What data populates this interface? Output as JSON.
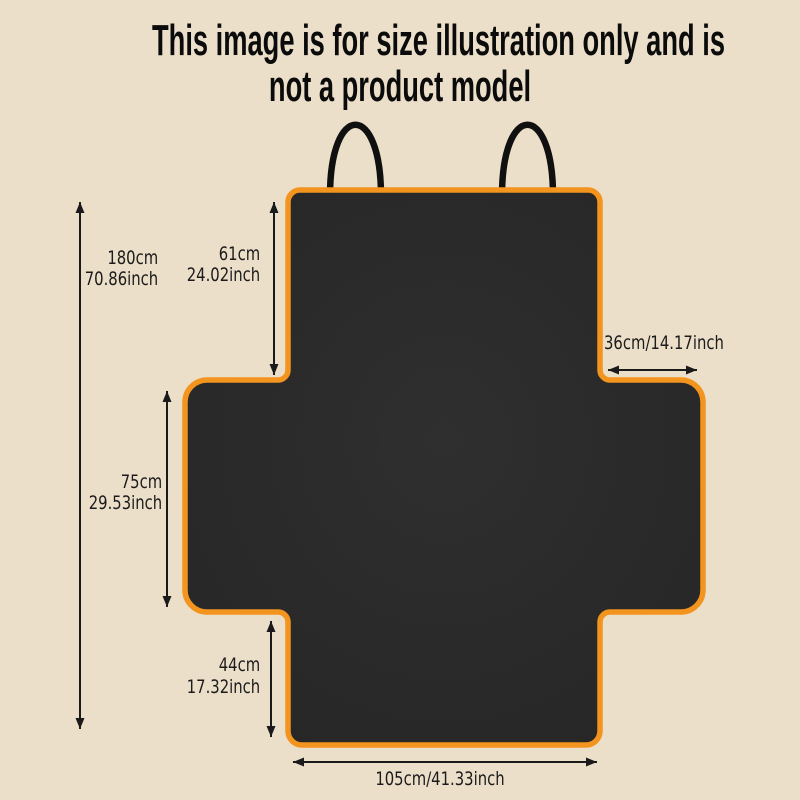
{
  "title": {
    "line1": "This image is for size illustration only and is",
    "line2": "not a product model"
  },
  "dims": {
    "d180": {
      "cm": "180cm",
      "inch": "70.86inch"
    },
    "d61": {
      "cm": "61cm",
      "inch": "24.02inch"
    },
    "d36": {
      "text": "36cm/14.17inch"
    },
    "d75": {
      "cm": "75cm",
      "inch": "29.53inch"
    },
    "d44": {
      "cm": "44cm",
      "inch": "17.32inch"
    },
    "d105": {
      "text": "105cm/41.33inch"
    }
  },
  "colors": {
    "background": "#ecdfc9",
    "cover_fill": "#2b2b2b",
    "border_orange": "#f2941e",
    "strap_black": "#101010",
    "arrow": "#1a1a1a",
    "text": "#1b1b1b"
  }
}
